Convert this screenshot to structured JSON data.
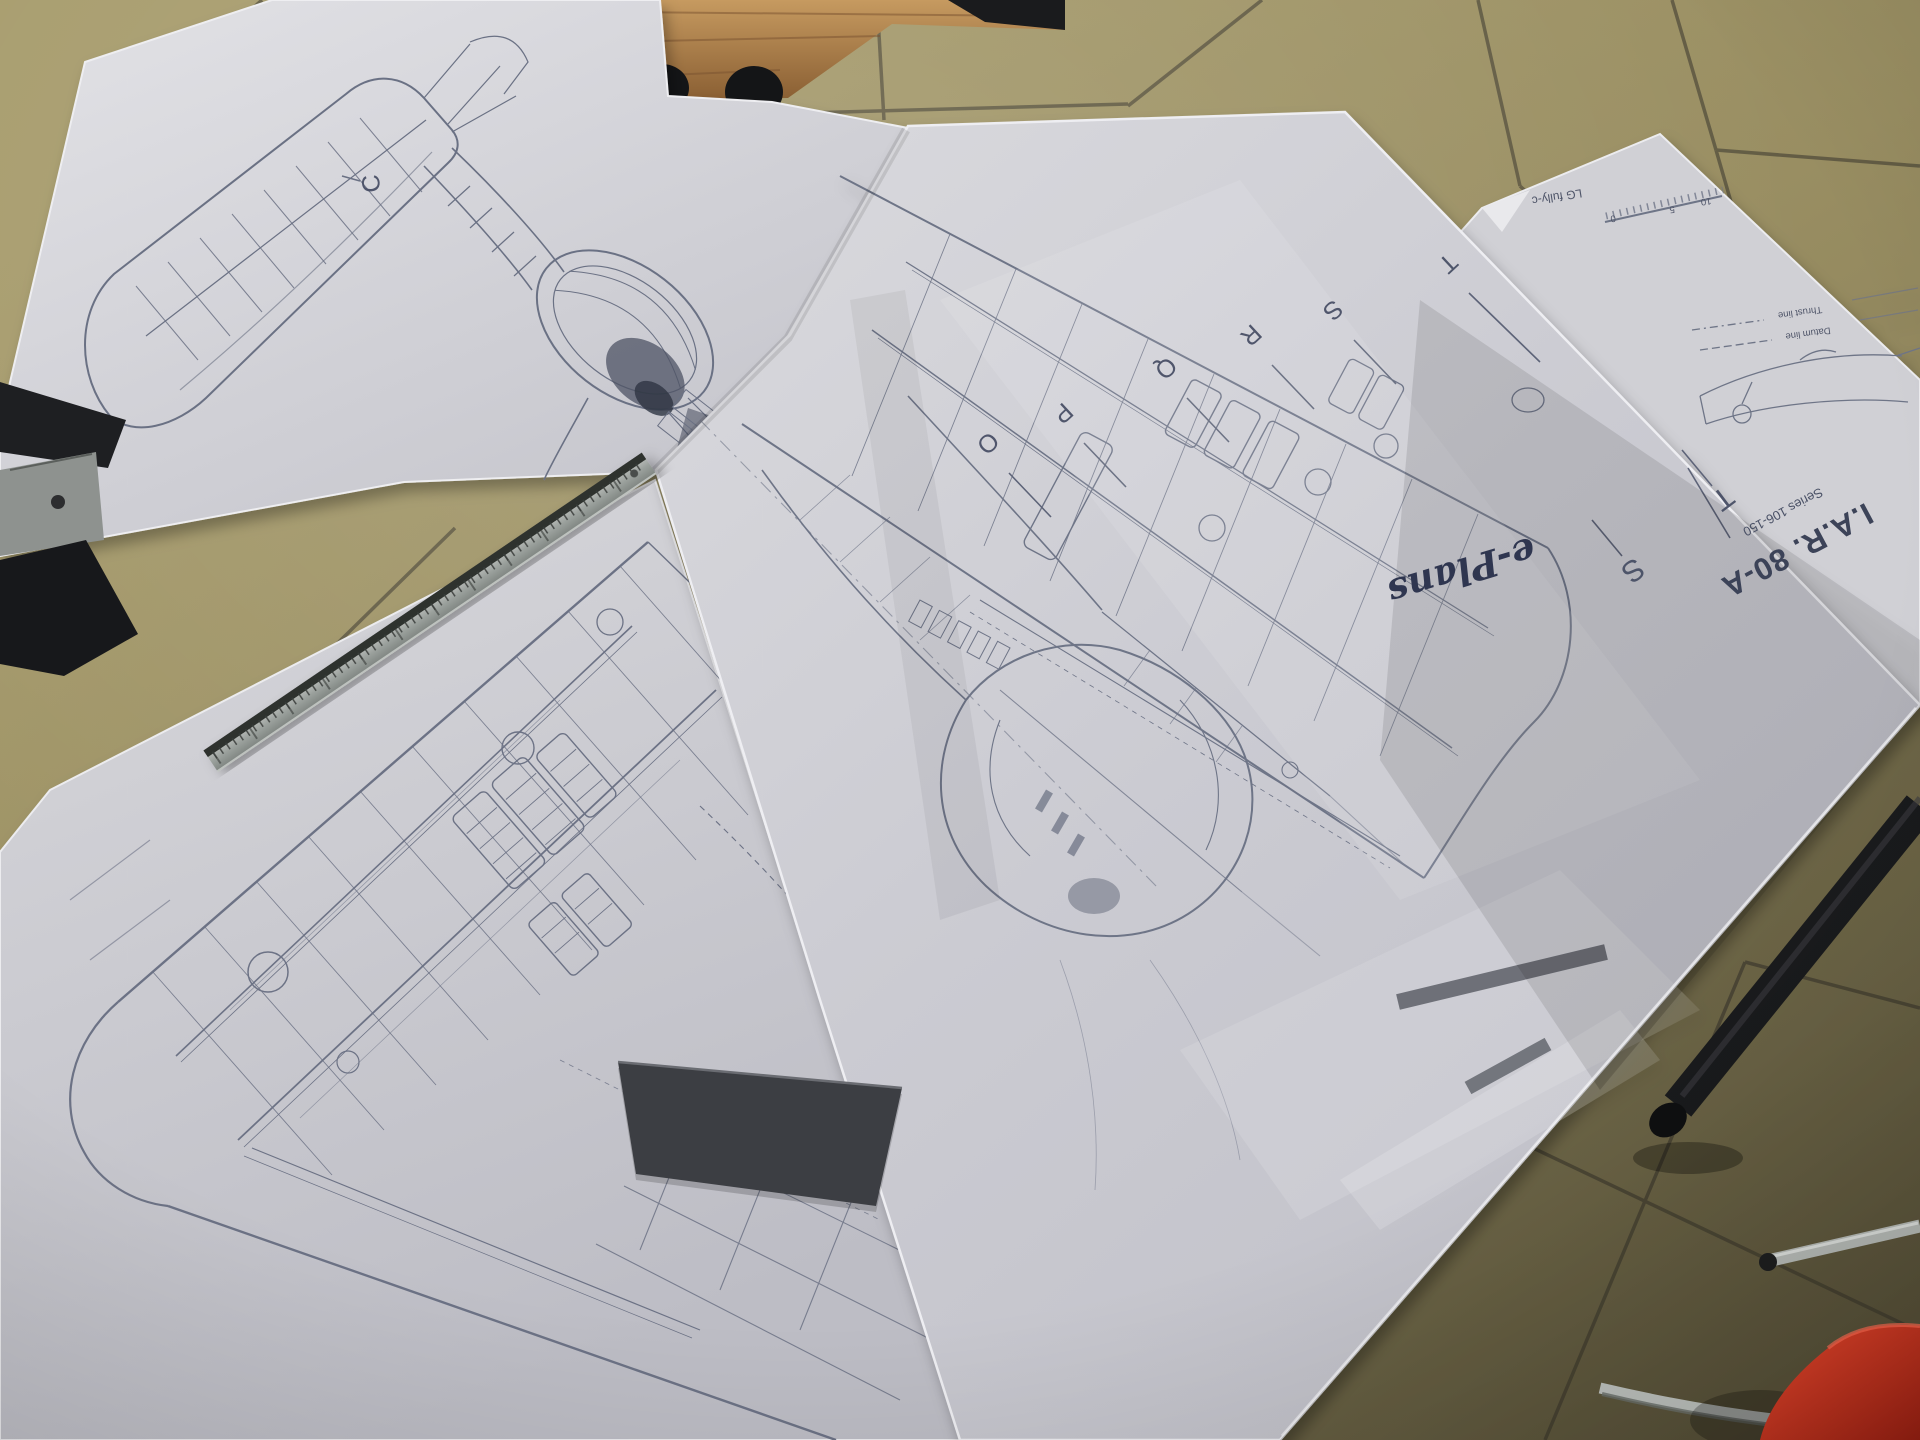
{
  "blueprint": {
    "title": "I.A.R. 80-A",
    "series": "Series 106-150",
    "publisher_script": "e-Plans",
    "notes": {
      "lg": "LG fully-c",
      "thrust": "Thrust line",
      "datum": "Datum line"
    },
    "scale_ticks": [
      "10",
      "5",
      "0"
    ],
    "stations": {
      "wing_fold": [
        "O",
        "P",
        "Q",
        "R",
        "S",
        "T"
      ],
      "fuselage": [
        "S",
        "T"
      ],
      "tailplane": "C"
    }
  },
  "colors": {
    "floor_tile": "#a39869",
    "floor_shadow": "#6e6647",
    "grout": "#4f4a39",
    "paper": "#d7d7db",
    "ink": "#6b7184",
    "wood": "#b08049",
    "ruler_steel": "#a3a8a5",
    "chair_red": "#d5301f",
    "leg_black": "#1b1c1e",
    "chrome": "#bcc0bc"
  }
}
